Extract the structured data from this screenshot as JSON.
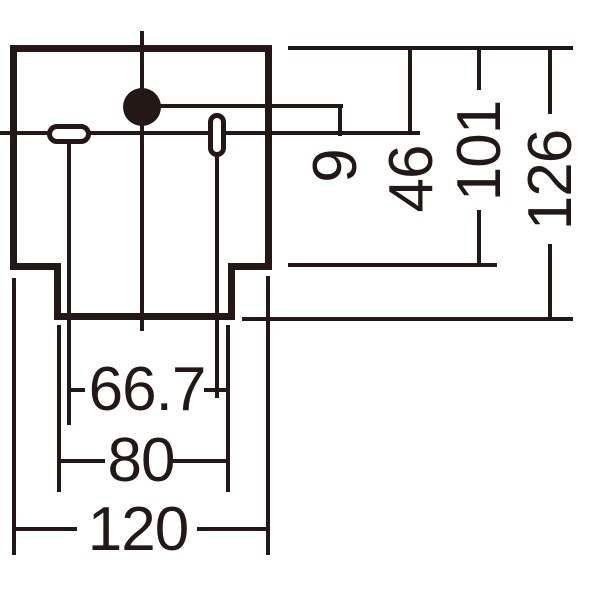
{
  "diagram": {
    "type": "luminaire installation dimension drawing",
    "line_color": "#231815",
    "background_color": "#ffffff",
    "dims": {
      "v9": "9",
      "v46": "46",
      "v101": "101",
      "v126": "126",
      "h66_7": "66.7",
      "h80": "80",
      "h120": "120"
    }
  }
}
